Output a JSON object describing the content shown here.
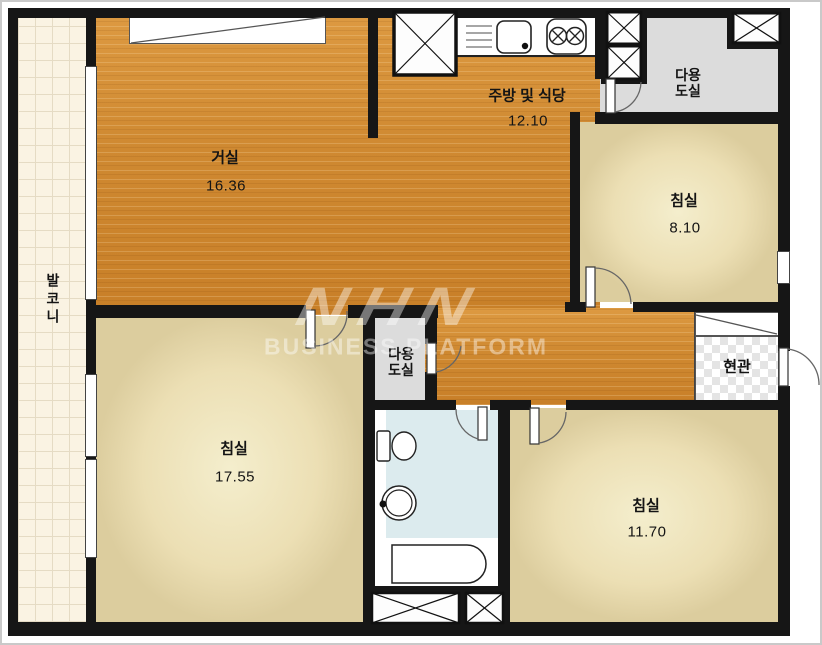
{
  "plan_title": "apartment-floor-plan",
  "rooms": {
    "balcony": {
      "label": "발코니"
    },
    "living": {
      "label": "거실",
      "area": "16.36"
    },
    "kitchen": {
      "label": "주방 및 식당",
      "area": "12.10"
    },
    "utility_top": {
      "line1": "다용",
      "line2": "도실"
    },
    "utility_mid": {
      "line1": "다용",
      "line2": "도실"
    },
    "bedroom_right": {
      "label": "침실",
      "area": "8.10"
    },
    "bedroom_left": {
      "label": "침실",
      "area": "17.55"
    },
    "bedroom_bottom": {
      "label": "침실",
      "area": "11.70"
    },
    "entrance": {
      "label": "현관"
    }
  },
  "fixtures": {
    "kitchen": [
      "refrigerator-box",
      "dish-rack",
      "sink",
      "stove-two-burners"
    ],
    "bathroom": [
      "toilet",
      "wash-basin",
      "bathtub"
    ],
    "ducts": [
      "duct-x-box-kitchen-1",
      "duct-x-box-kitchen-2",
      "duct-x-box-top-right",
      "duct-x-box-bottom-1",
      "duct-x-box-bottom-2"
    ],
    "closets": [
      "wardrobe-top-left",
      "shoe-cabinet-entrance"
    ],
    "doors": [
      "door-bedroom-left",
      "door-utility-mid",
      "door-utility-top",
      "door-bedroom-right",
      "door-bathroom",
      "door-bedroom-bottom",
      "door-entrance"
    ]
  },
  "watermark": {
    "logo": "NHN",
    "text": "BUSINESS PLATFORM"
  },
  "colors": {
    "wood": "#cf8931",
    "bedroom": "#efe6c1",
    "balcony_tile": "#faf3e3",
    "utility_gray": "#dcdcdc",
    "bathroom_blue": "#dcebee",
    "wall": "#161616",
    "entrance_checker": "#e4e4e4",
    "watermark": "rgba(255,255,255,0.42)"
  }
}
